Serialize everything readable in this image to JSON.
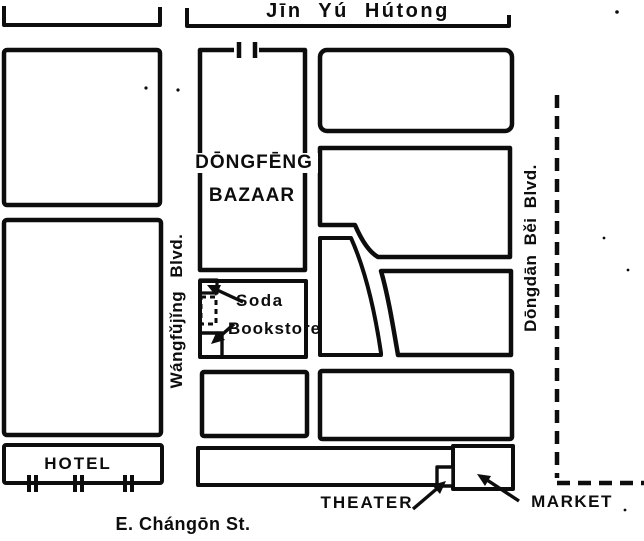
{
  "streets": {
    "top_hutong": "Jīn Yú Hútong",
    "west_blvd": "Wángfǔjǐng Blvd.",
    "east_blvd": "Dōngdān  Běi  Blvd.",
    "south_st": "E. Chángōn St."
  },
  "places": {
    "bazaar_name": "DŌNGFĒNG",
    "bazaar_type": "BAZAAR",
    "soda": "Soda",
    "bookstore": "Bookstore",
    "hotel": "HOTEL",
    "theater": "THEATER",
    "market": "MARKET"
  },
  "colors": {
    "ink": "#0d0d0d",
    "paper": "#ffffff"
  }
}
